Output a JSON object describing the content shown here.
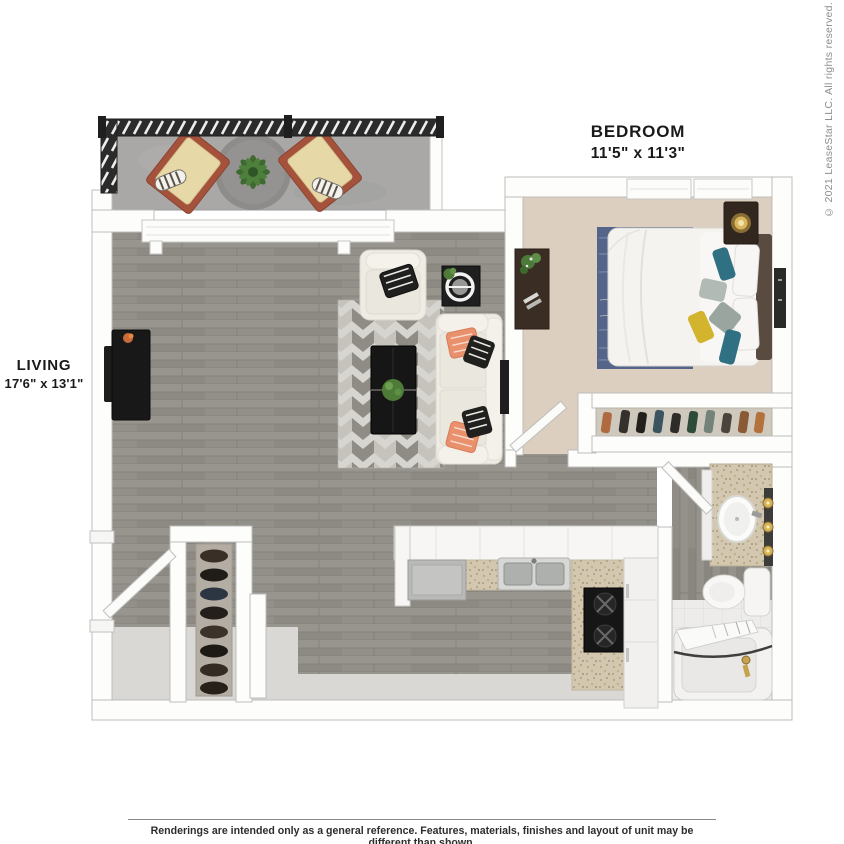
{
  "plan": {
    "labels": {
      "bedroom": {
        "name": "BEDROOM",
        "dimensions": "11'5\" x 11'3\""
      },
      "living": {
        "name": "LIVING",
        "dimensions": "17'6\" x 13'1\""
      }
    },
    "copyright": "© 2021 LeaseStar LLC. All rights reserved.",
    "disclaimer": "Renderings are intended only as a general reference. Features, materials, finishes and layout of unit may be different than shown.",
    "rooms": [
      "balcony",
      "living",
      "kitchen",
      "entry",
      "bedroom",
      "closet",
      "bathroom"
    ],
    "furniture_icons": [
      "balcony-railing",
      "lounge-chair",
      "lounge-chair",
      "patio-plant",
      "tv-console",
      "wall-tv",
      "armchair",
      "side-table",
      "sofa",
      "coffee-table",
      "chevron-rug",
      "bed",
      "headboard",
      "pillows",
      "nightstand",
      "table-lamp",
      "bedroom-desk",
      "bedroom-rug",
      "wall-art",
      "shoe-shelf",
      "entry-closet",
      "wine-rack",
      "entry-door",
      "bedroom-door",
      "bathroom-door",
      "kitchen-counter",
      "dishwasher",
      "double-sink",
      "range-stove",
      "refrigerator",
      "bathroom-vanity",
      "vanity-sink",
      "vanity-lights",
      "toilet",
      "bathtub",
      "shower-curtain"
    ],
    "colors": {
      "wall": "#fdfdfc",
      "wall_outline": "#bdbdbb",
      "wood_floor": "#918e88",
      "entry_floor": "#d9d8d5",
      "carpet": "#dccfc0",
      "balcony_floor": "#a9a8a6",
      "railing": "#2b2b2b",
      "tile": "#edecea",
      "granite": "#d3c8af",
      "blue_rug": "#55658a",
      "chevron_light": "#c6c3bd",
      "chevron_dark": "#8f8c86",
      "cream": "#efece4",
      "coral": "#e9906c",
      "teal": "#2f7183",
      "yellow": "#d3b42f",
      "dark_wood": "#32271f",
      "black_furniture": "#181818",
      "plant_green": "#4e7c38",
      "gold": "#d0ab52",
      "label_text": "#1a1a1a",
      "muted_text": "#8e8e8c"
    }
  }
}
